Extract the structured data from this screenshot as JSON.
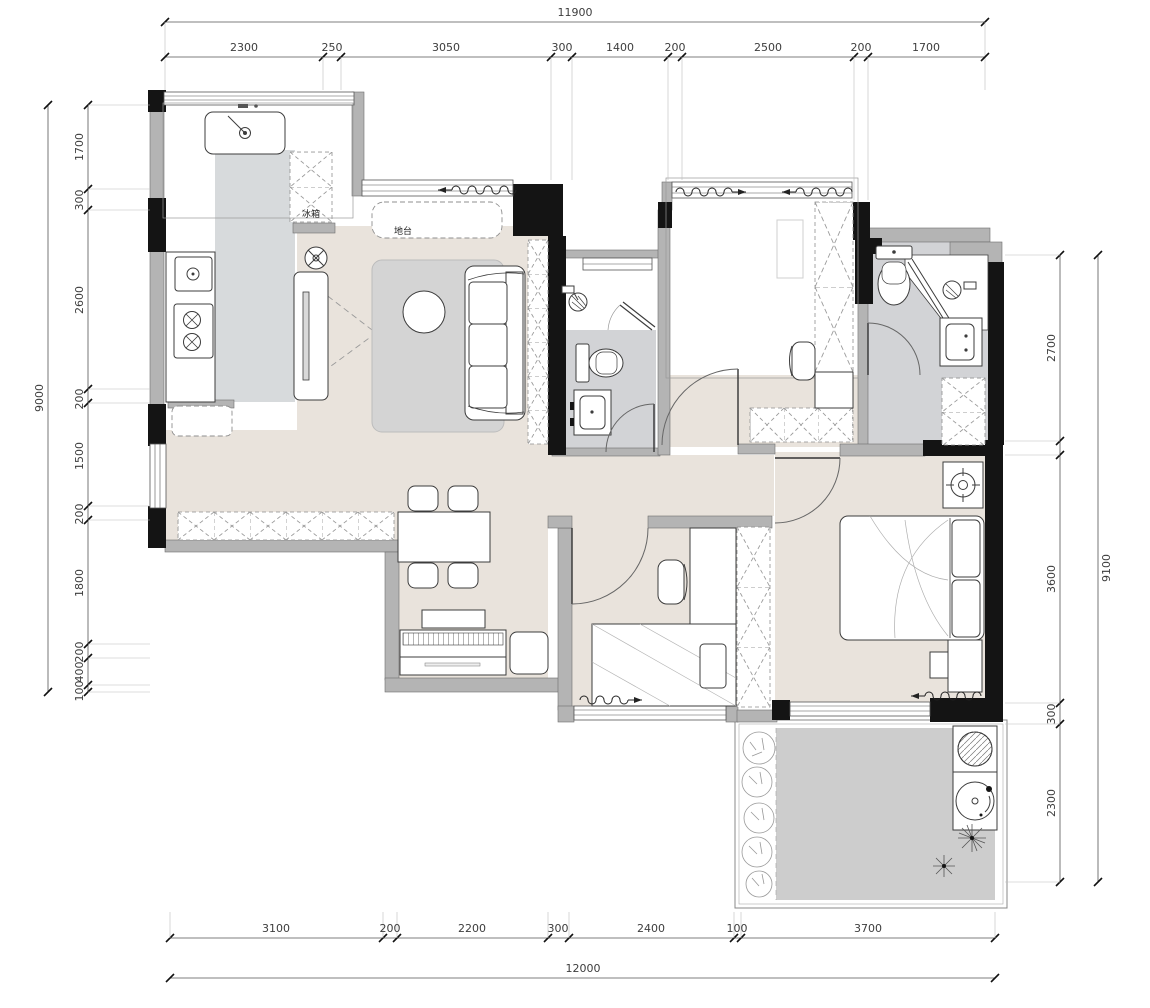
{
  "title": "apartment-floor-plan",
  "colors": {
    "wall_black": "#141414",
    "wall_gray": "#b4b4b4",
    "floor_beige": "#e9e3dc",
    "floor_kitchen_gray": "#d7dadc",
    "floor_bath_gray": "#d2d3d6",
    "floor_balcony_gray": "#cdcdcd",
    "dimension_text": "#3d3d3d"
  },
  "labels": {
    "fridge": "冰箱",
    "platform": "地台"
  },
  "dims": {
    "top": {
      "overall": "11900",
      "segments": [
        "2300",
        "250",
        "3050",
        "300",
        "1400",
        "200",
        "2500",
        "200",
        "1700"
      ]
    },
    "bottom": {
      "overall": "12000",
      "segments": [
        "3100",
        "200",
        "2200",
        "300",
        "2400",
        "100",
        "3700"
      ]
    },
    "left": {
      "overall": "9000",
      "segments": [
        "1700",
        "300",
        "2600",
        "200",
        "1500",
        "200",
        "1800",
        "200",
        "400",
        "100"
      ]
    },
    "right": {
      "overall": "9100",
      "segments": [
        "2700",
        "",
        "3600",
        "300",
        "2300"
      ]
    }
  }
}
